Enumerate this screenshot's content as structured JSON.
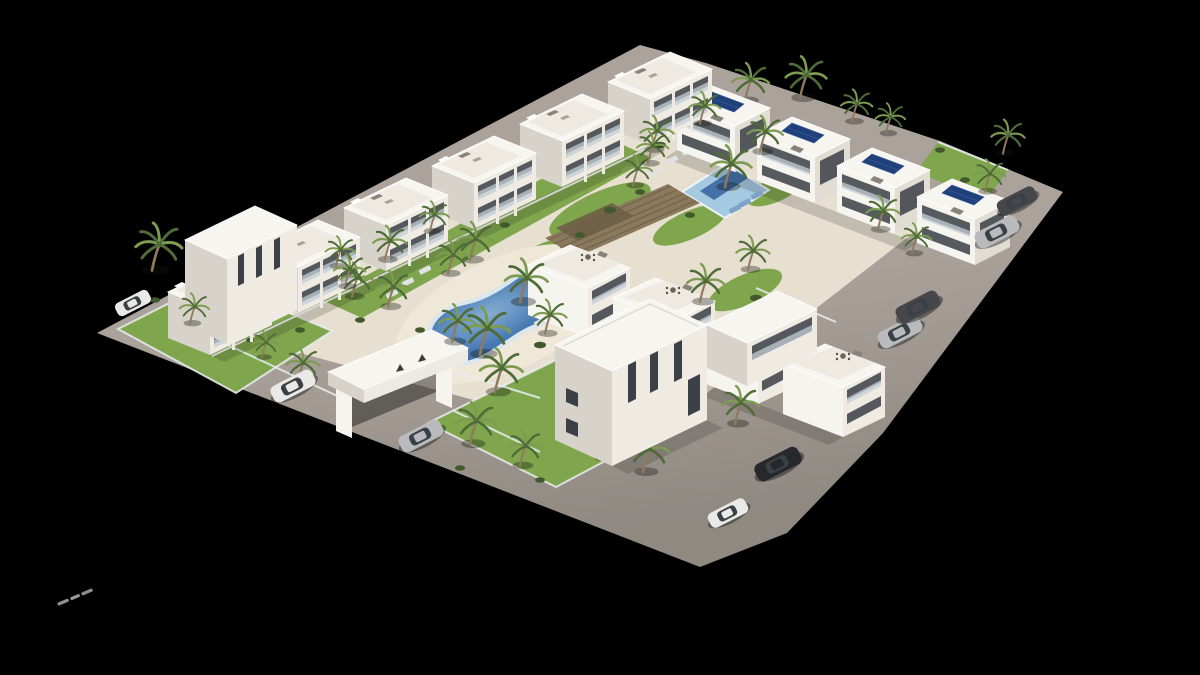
{
  "scene": {
    "type": "3d-architectural-render",
    "description": "Aerial 3D rendering of a white Mediterranean apartment complex with a kidney-shaped courtyard pool, a rectangular pool, wooden sun terraces, palm trees, landscaped gardens, an entrance gate and parked cars, isolated on a black background",
    "background": "#000000"
  },
  "palette": {
    "background": "#000000",
    "road": "#aba39b",
    "plaza": "#e7e0d1",
    "deck": "#efe8d9",
    "roof": "#f7f5f0",
    "roof_terrace": "#eeeae1",
    "front": "#efebe3",
    "front_bright": "#f6f4ee",
    "side": "#d7d3ca",
    "side2": "#e1ddd4",
    "glass": "#3a4046",
    "railing": "#c3ced4",
    "lawn": "#7fa64d",
    "bush": "#42592e",
    "palm_dark": "#4e6b38",
    "palm_light": "#7e9b52",
    "trunk": "#8f7a5e",
    "pool_deep": "#35659f",
    "pool_mid": "#4a7cb4",
    "pool_light": "#86aed3",
    "pool_rim": "#d9e6ee",
    "pool_flat": "#a6c9e2",
    "lane": "#31619d",
    "solar": "#20407a",
    "wood": "#8a795c",
    "wood_dark": "#6e5f46",
    "fence": "#e9edf0",
    "shadow": "rgba(25,25,20,0.18)",
    "lounger": "#dfe3e5",
    "lounger_blue": "#7fa3c8",
    "car_white": "#e9e9e7",
    "car_silver": "#b9babd",
    "car_dark": "#45474c",
    "car_black": "#26282c"
  },
  "objects": {
    "palms_back": [
      [
        745,
        99,
        1.0
      ],
      [
        800,
        96,
        1.1
      ],
      [
        852,
        120,
        0.85
      ],
      [
        886,
        132,
        0.8
      ],
      [
        720,
        133,
        0.8
      ],
      [
        690,
        128,
        0.75
      ]
    ],
    "palms": [
      [
        760,
        150,
        0.95
      ],
      [
        700,
        122,
        0.85
      ],
      [
        652,
        148,
        0.9
      ],
      [
        633,
        184,
        0.8
      ],
      [
        725,
        185,
        1.1
      ],
      [
        648,
        162,
        0.85
      ],
      [
        470,
        258,
        1.0
      ],
      [
        448,
        272,
        0.9
      ],
      [
        520,
        300,
        1.15
      ],
      [
        480,
        352,
        1.25
      ],
      [
        452,
        340,
        1.0
      ],
      [
        388,
        305,
        0.95
      ],
      [
        352,
        295,
        0.9
      ],
      [
        336,
        265,
        0.8
      ],
      [
        545,
        332,
        0.9
      ],
      [
        385,
        258,
        0.9
      ],
      [
        430,
        230,
        0.8
      ],
      [
        345,
        285,
        0.85
      ],
      [
        700,
        300,
        1.0
      ],
      [
        748,
        268,
        0.9
      ],
      [
        878,
        228,
        0.9
      ],
      [
        912,
        252,
        0.8
      ],
      [
        1003,
        152,
        0.9
      ],
      [
        985,
        190,
        0.85
      ],
      [
        152,
        268,
        1.25
      ],
      [
        190,
        322,
        0.8
      ],
      [
        298,
        380,
        0.9
      ],
      [
        262,
        356,
        0.7
      ],
      [
        470,
        442,
        1.1
      ],
      [
        520,
        464,
        0.95
      ],
      [
        612,
        440,
        1.0
      ],
      [
        643,
        470,
        1.1
      ],
      [
        583,
        416,
        0.8
      ],
      [
        495,
        390,
        1.15
      ],
      [
        735,
        422,
        1.0
      ],
      [
        762,
        332,
        0.85
      ]
    ],
    "bushes": [
      [
        660,
        145,
        6
      ],
      [
        700,
        135,
        5
      ],
      [
        745,
        150,
        6
      ],
      [
        778,
        165,
        5
      ],
      [
        800,
        185,
        6
      ],
      [
        690,
        215,
        5
      ],
      [
        640,
        192,
        5
      ],
      [
        610,
        210,
        6
      ],
      [
        580,
        235,
        5
      ],
      [
        560,
        255,
        5
      ],
      [
        620,
        300,
        6
      ],
      [
        650,
        320,
        5
      ],
      [
        680,
        335,
        5
      ],
      [
        540,
        345,
        6
      ],
      [
        420,
        330,
        5
      ],
      [
        360,
        320,
        5
      ],
      [
        300,
        330,
        5
      ],
      [
        250,
        340,
        4
      ],
      [
        155,
        300,
        5
      ],
      [
        940,
        150,
        5
      ],
      [
        965,
        180,
        5
      ],
      [
        756,
        298,
        6
      ],
      [
        800,
        320,
        5
      ],
      [
        460,
        468,
        5
      ],
      [
        540,
        480,
        5
      ],
      [
        600,
        458,
        5
      ],
      [
        418,
        250,
        4
      ],
      [
        505,
        225,
        5
      ]
    ],
    "loungers": [
      [
        408,
        282,
        "g"
      ],
      [
        425,
        270,
        "g"
      ],
      [
        392,
        294,
        "g"
      ],
      [
        540,
        322,
        "g"
      ],
      [
        560,
        312,
        "g"
      ],
      [
        672,
        160,
        "g"
      ],
      [
        688,
        151,
        "g"
      ],
      [
        654,
        172,
        "g"
      ],
      [
        745,
        203,
        "b"
      ],
      [
        757,
        195,
        "b"
      ],
      [
        735,
        209,
        "b"
      ]
    ],
    "modules_back_left": [
      [
        608,
        82
      ],
      [
        520,
        124
      ],
      [
        432,
        166
      ],
      [
        344,
        208
      ],
      [
        256,
        250
      ],
      [
        168,
        292
      ]
    ],
    "modules_back_right": [
      [
        712,
        86
      ],
      [
        792,
        117
      ],
      [
        872,
        148
      ],
      [
        952,
        179
      ]
    ],
    "modules_middle": [
      [
        570,
        245
      ],
      [
        655,
        278
      ],
      [
        740,
        311
      ],
      [
        825,
        344
      ]
    ],
    "cars": [
      {
        "x": 133,
        "y": 303,
        "color": "white",
        "s": 0.8
      },
      {
        "x": 293,
        "y": 386,
        "color": "white",
        "s": 1.0
      },
      {
        "x": 421,
        "y": 436,
        "color": "silver",
        "s": 1.0
      },
      {
        "x": 728,
        "y": 513,
        "color": "white",
        "s": 0.9
      },
      {
        "x": 778,
        "y": 464,
        "color": "black",
        "s": 1.05
      },
      {
        "x": 900,
        "y": 332,
        "color": "silver",
        "s": 1.0
      },
      {
        "x": 918,
        "y": 307,
        "color": "dark",
        "s": 1.0
      },
      {
        "x": 997,
        "y": 232,
        "color": "silver",
        "s": 1.0
      },
      {
        "x": 1017,
        "y": 201,
        "color": "dark",
        "s": 0.9
      }
    ],
    "watermark": {
      "x": 57,
      "y": 603,
      "angle": -23,
      "legible_text": ""
    }
  }
}
